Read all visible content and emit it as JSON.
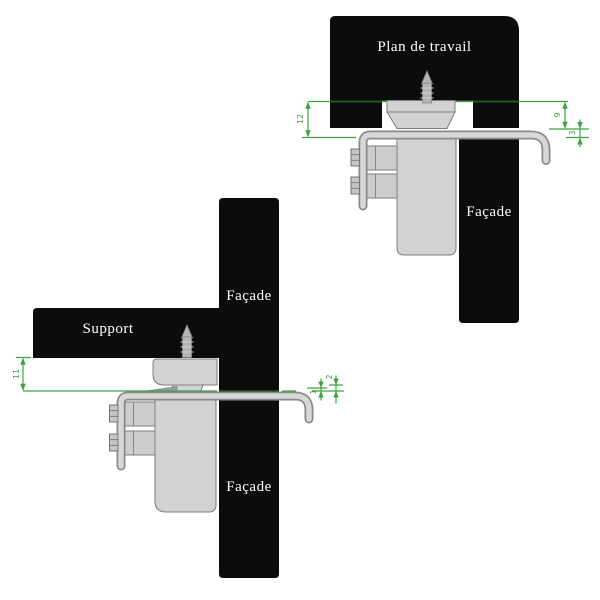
{
  "diagram_top": {
    "worktop_label": "Plan de travail",
    "facade_label": "Façade",
    "dimensions": {
      "left": "12",
      "right_first": "9",
      "right_second": "3"
    }
  },
  "diagram_bottom": {
    "support_label": "Support",
    "facade_label_upper": "Façade",
    "facade_label_lower": "Façade",
    "dimensions": {
      "left": "11",
      "right_first": "1",
      "right_second": "2"
    }
  },
  "colors": {
    "background": "#ffffff",
    "panel_black": "#0c0c0c",
    "label_white": "#ffffff",
    "part_gray": "#d2d2d2",
    "part_outline": "#7d7d7d",
    "metal_light": "#d8d8d8",
    "metal_outline": "#8a8a8a",
    "dimension_green": "#3fa33f",
    "dimension_green_dark": "#1d6020"
  }
}
